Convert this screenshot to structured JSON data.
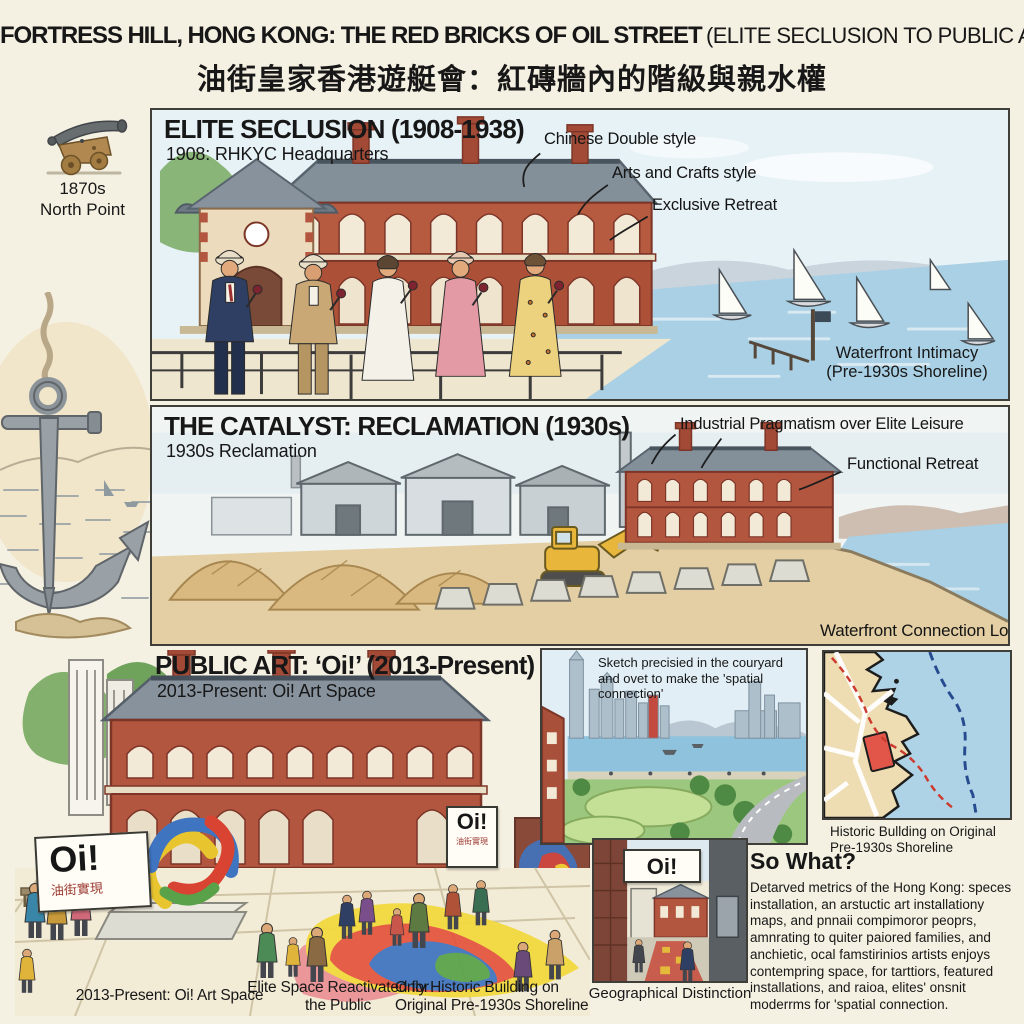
{
  "title": {
    "main": "FORTRESS HILL, HONG KONG: THE RED BRICKS OF OIL STREET",
    "paren": "(ELITE SECLUSION TO PUBLIC ART)",
    "chinese": "油街皇家香港遊艇會：紅磚牆內的階級與親水權"
  },
  "colors": {
    "background": "#f4f0e2",
    "brick_red": "#b3563f",
    "water_blue": "#a9d0e4",
    "accent_red": "#cc3b2f",
    "ink": "#171717"
  },
  "left_margin": {
    "cannon_icon": "cannon-icon",
    "cannon_caption_line1": "1870s",
    "cannon_caption_line2": "North Point",
    "anchor_icon": "anchor-icon"
  },
  "panel1": {
    "heading": "ELITE SECLUSION (1908-1938)",
    "subheading": "1908: RHKYC Headquarters",
    "annotations": [
      "Chinese Double style",
      "Arts and Crafts style",
      "Exclusive Retreat"
    ],
    "waterfront_label_line1": "Waterfront Intimacy",
    "waterfront_label_line2": "(Pre-1930s Shoreline)"
  },
  "panel2": {
    "heading": "THE CATALYST: RECLAMATION (1930s)",
    "subheading": "1930s Reclamation",
    "annotations": [
      "Industrial Pragmatism over Elite Leisure",
      "Functional Retreat"
    ],
    "waterfront_label": "Waterfront Connection Lost"
  },
  "panel3": {
    "heading": "PUBLIC ART: ‘Oi!’ (2013-Present)",
    "subheading": "2013-Present: Oi! Art Space",
    "left_sign": {
      "main": "Oi!",
      "chinese": "油街實現"
    },
    "building_sign": {
      "main": "Oi!",
      "chinese": "油街實現"
    },
    "sketch_inset_caption": "Sketch precisied in the couryard and ovet to make the 'spatial connection'",
    "map_caption_line1": "Historic Bullding on Original",
    "map_caption_line2": "Pre-1930s Shoreline",
    "corridor_sign": "Oi!",
    "corridor_caption": "Geographical Distinction",
    "so_what": {
      "heading": "So What?",
      "body": "Detarved metrics of the Hong Kong: speces installation, an arstuctic art installationy maps, and pnnaii compimoror peoprs, amnrating to quiter paiored families, and anchietic, ocal famstirinios artists enjoys contempring space, for tarttiors, featured installations, and raioa, elites' onsnit moderrms for 'spatial connection."
    },
    "bottom_captions": [
      "2013-Present: Oi! Art Space",
      "Elite Space Reactivated for the Public",
      "Only Historic Building on Original Pre-1930s Shoreline"
    ]
  }
}
